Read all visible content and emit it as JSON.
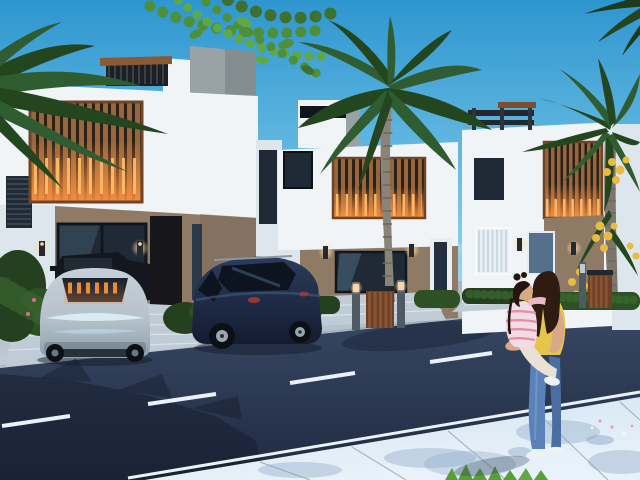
{
  "scene": {
    "type": "architectural-3d-render",
    "setting": "modern residential villas along a street at dusk with interior lights on",
    "labels": {
      "sky": "clear blue sky with faint clouds",
      "house_left": "white two-story villa, rooftop pergola, warm-lit wood slat facade panel",
      "house_middle": "white two-story villa with wood slat accent and palm in front",
      "house_right": "white two-story villa with rooftop pergola and wood slat accent",
      "sedan": "silver-blue sedan, rear view, parked in driveway",
      "pickup": "dark pickup truck parked beyond sedan",
      "suv": "dark navy SUV, rear three-quarter view, parked in driveway",
      "woman": "woman in yellow top and blue jeans holding a child, standing on sidewalk",
      "child": "child in pink-striped top with pigtails held on hip",
      "road": "dark asphalt street with white dashed center line and double edge lines",
      "sidewalk": "pale blue paved sidewalk with leaf shadows",
      "palm_center": "tall palm tree in front of middle villa",
      "palm_right": "palm tree with yellow flower clusters at right",
      "leaves_top": "green tree foliage overhanging the top of the frame",
      "street_furniture": "bollard lights and wooden trash bins along the driveways"
    }
  },
  "palette": {
    "skyTop": "#2e96cf",
    "skyMid": "#79c6e8",
    "skyHorizon": "#d8eef7",
    "cloudWhite": "#ffffff",
    "wallWhite": "#f0f4f7",
    "wallShade": "#dde6ec",
    "wallTan": "#8f7a66",
    "wallTanDark": "#7c695a",
    "concreteGray": "#99a2a5",
    "concreteDark": "#848d90",
    "woodSlat": "#96663f",
    "woodSlatDark": "#6e4527",
    "panelBase": "#2c2014",
    "glowOrange": "#ff9240",
    "glowBright": "#ffc06a",
    "frameDark": "#10161d",
    "glassDark": "#1f2a36",
    "glassBlue": "#54708a",
    "blindsWhite": "#e8eef2",
    "doorDark": "#17161b",
    "greenDark": "#24401e",
    "greenMid": "#3c6a30",
    "greenLight": "#5fa846",
    "leafGreen": "#4e8f3a",
    "palmDark": "#23461f",
    "palmMid": "#2f5c30",
    "trunkGray": "#8a8478",
    "trunkDark": "#6e685e",
    "fruitYellow": "#e9bc3e",
    "roadTop": "#3a4a66",
    "roadBottom": "#1f2a40",
    "lineWhite": "#e9f2f8",
    "shadowNavy": "#131c2c",
    "pavingLight": "#bfccd6",
    "pavingMid": "#a9b6c0",
    "jointGray": "#8fa0ac",
    "sidewalkLight": "#d2e4f2",
    "sidewalkShade": "#8fa8c6",
    "carSilver": "#b7c2cb",
    "carSilverDark": "#8da0ad",
    "carIce": "#dff2fa",
    "carGlassDark": "#1d242e",
    "suvNavy": "#1d2a44",
    "suvHi": "#3d5578",
    "tireDark": "#0c1016",
    "alloyGray": "#9aa6b2",
    "pickupDark": "#14171d",
    "skin": "#d9a987",
    "hairBrown": "#2e1b12",
    "hairChild": "#241510",
    "topYellow": "#e5c54b",
    "topYellowShade": "#c2a33a",
    "jeans": "#5b82b8",
    "jeansShade": "#4a6ea2",
    "jeansHi": "#7ea3d0",
    "shoeWhite": "#eef2f5",
    "childShirt": "#f3dde4",
    "childStripe": "#e487a4",
    "childLegging": "#e9e1d5",
    "binWood": "#6e4026",
    "binWoodLight": "#8a5434",
    "bollardGray": "#4e5a64",
    "lampGlow": "#ffd9a8",
    "grassGreen": "#5a9e3c",
    "petalPink": "#e8a0b4"
  },
  "objects": {
    "houses": [
      {
        "position": "left",
        "floors": 2,
        "facade": [
          "white",
          "tan-ground-floor",
          "lit-wood-slat-panel",
          "roof-pergola",
          "gray-stair-tower"
        ],
        "openings": [
          "large-glass-window",
          "dark-entry-door",
          "narrow-sidelight"
        ],
        "lights": [
          "wall-sconces",
          "warm-slat-glow"
        ]
      },
      {
        "position": "middle",
        "floors": 2,
        "facade": [
          "white",
          "tan-ground-floor",
          "lit-wood-slat-panel",
          "rooftop-block"
        ],
        "openings": [
          "dark-upper-window",
          "wide-ground-window",
          "white-framed-door"
        ],
        "lights": [
          "wall-sconces"
        ]
      },
      {
        "position": "right",
        "floors": 2,
        "facade": [
          "white",
          "tan-section",
          "lit-wood-slat-panel",
          "roof-pergola"
        ],
        "openings": [
          "dark-upper-window",
          "blinds-window",
          "glass-window"
        ],
        "lights": [
          "wall-sconces"
        ]
      }
    ],
    "vehicles": [
      {
        "kind": "sedan",
        "color": "silver-blue",
        "view": "rear",
        "detail": "warm lights reflected in rear window"
      },
      {
        "kind": "pickup-truck",
        "color": "black",
        "view": "partial-behind-sedan"
      },
      {
        "kind": "suv",
        "color": "dark-navy",
        "view": "rear-three-quarter",
        "detail": "roof rails, alloy wheels"
      }
    ],
    "figures": [
      {
        "kind": "woman",
        "hair": "dark-brown",
        "top": "yellow",
        "pants": "blue-jeans",
        "shoes": "white-sneakers",
        "pose": "standing, back to viewer, holding child"
      },
      {
        "kind": "child",
        "hair": "dark-pigtails",
        "top": "pink-white-stripes",
        "legs": "cream-leggings",
        "shoes": "white-sneaker",
        "pose": "carried on hip"
      }
    ],
    "vegetation": [
      "overhanging-green-leaves-top",
      "left-corner-palm-fronds",
      "center-palm-tree",
      "right-palm-with-yellow-clusters",
      "hedge-rows",
      "flowering-shrub",
      "grass-tuft"
    ],
    "street": {
      "markings": [
        "white-dashed-center-line",
        "double-white-edge-lines"
      ],
      "features": [
        "asphalt-road",
        "pale-sidewalk",
        "paved-driveways",
        "bollard-lights",
        "wooden-trash-bins",
        "palm-shadow-on-road",
        "leaf-shadows-on-sidewalk"
      ]
    }
  }
}
